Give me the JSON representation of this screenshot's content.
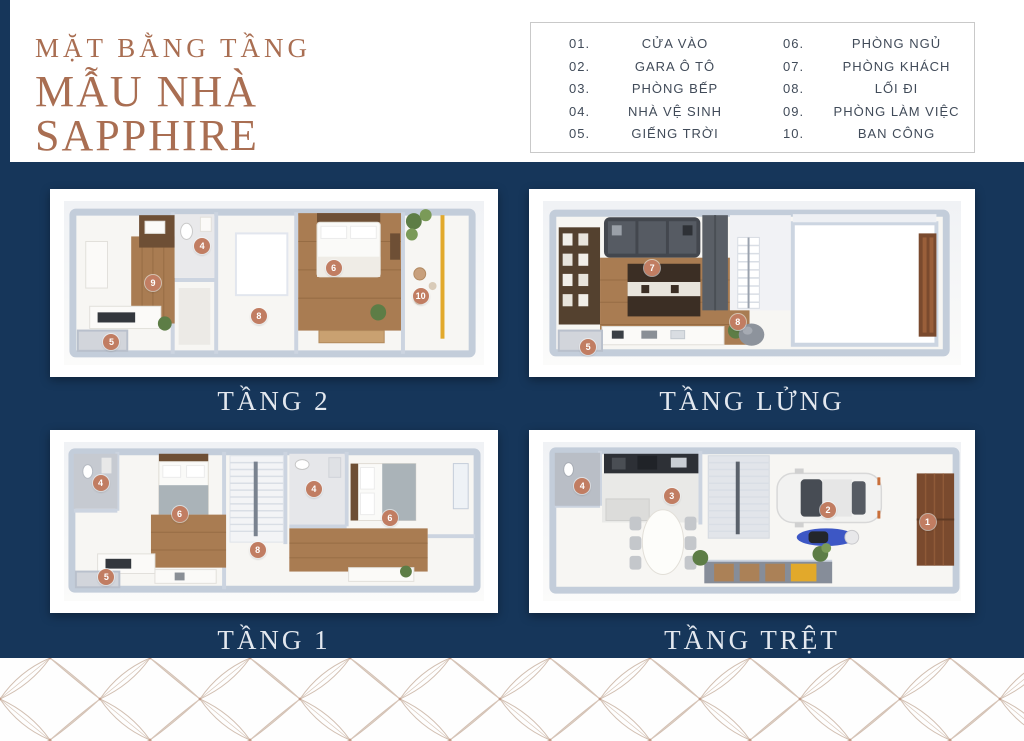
{
  "header": {
    "title_line1": "MẶT BẰNG TẦNG",
    "title_line2": "MẪU NHÀ SAPPHIRE"
  },
  "legend": {
    "items": [
      {
        "num": "01.",
        "label": "CỬA VÀO"
      },
      {
        "num": "02.",
        "label": "GARA Ô TÔ"
      },
      {
        "num": "03.",
        "label": "PHÒNG BẾP"
      },
      {
        "num": "04.",
        "label": "NHÀ VỆ SINH"
      },
      {
        "num": "05.",
        "label": "GIẾNG TRỜI"
      },
      {
        "num": "06.",
        "label": "PHÒNG NGỦ"
      },
      {
        "num": "07.",
        "label": "PHÒNG KHÁCH"
      },
      {
        "num": "08.",
        "label": "LỐI ĐI"
      },
      {
        "num": "09.",
        "label": "PHÒNG LÀM VIỆC"
      },
      {
        "num": "10.",
        "label": "BAN CÔNG"
      }
    ]
  },
  "floors": [
    {
      "caption": "TẦNG 2",
      "badges": [
        {
          "n": "9",
          "x": 21.2,
          "y": 50
        },
        {
          "n": "4",
          "x": 32.9,
          "y": 27.2
        },
        {
          "n": "8",
          "x": 46.4,
          "y": 70.4
        },
        {
          "n": "6",
          "x": 64.2,
          "y": 40.7
        },
        {
          "n": "10",
          "x": 84.9,
          "y": 58
        },
        {
          "n": "5",
          "x": 11.3,
          "y": 85.8
        }
      ]
    },
    {
      "caption": "TẦNG LỬNG",
      "badges": [
        {
          "n": "7",
          "x": 26.1,
          "y": 40.7
        },
        {
          "n": "8",
          "x": 46.6,
          "y": 73.5
        },
        {
          "n": "5",
          "x": 10.8,
          "y": 88.9
        }
      ]
    },
    {
      "caption": "TẦNG 1",
      "badges": [
        {
          "n": "4",
          "x": 8.7,
          "y": 25.9
        },
        {
          "n": "6",
          "x": 27.5,
          "y": 45.1
        },
        {
          "n": "8",
          "x": 46.1,
          "y": 67.9
        },
        {
          "n": "4",
          "x": 59.5,
          "y": 29.6
        },
        {
          "n": "6",
          "x": 77.6,
          "y": 47.5
        },
        {
          "n": "5",
          "x": 10.1,
          "y": 85.2
        }
      ]
    },
    {
      "caption": "TẦNG TRỆT",
      "badges": [
        {
          "n": "4",
          "x": 9.4,
          "y": 27.8
        },
        {
          "n": "3",
          "x": 30.8,
          "y": 34
        },
        {
          "n": "2",
          "x": 68.2,
          "y": 42.6
        },
        {
          "n": "1",
          "x": 92,
          "y": 50.6
        }
      ]
    }
  ],
  "colors": {
    "navy": "#16365a",
    "copper": "#a96e52",
    "badge": "#c17d62"
  }
}
